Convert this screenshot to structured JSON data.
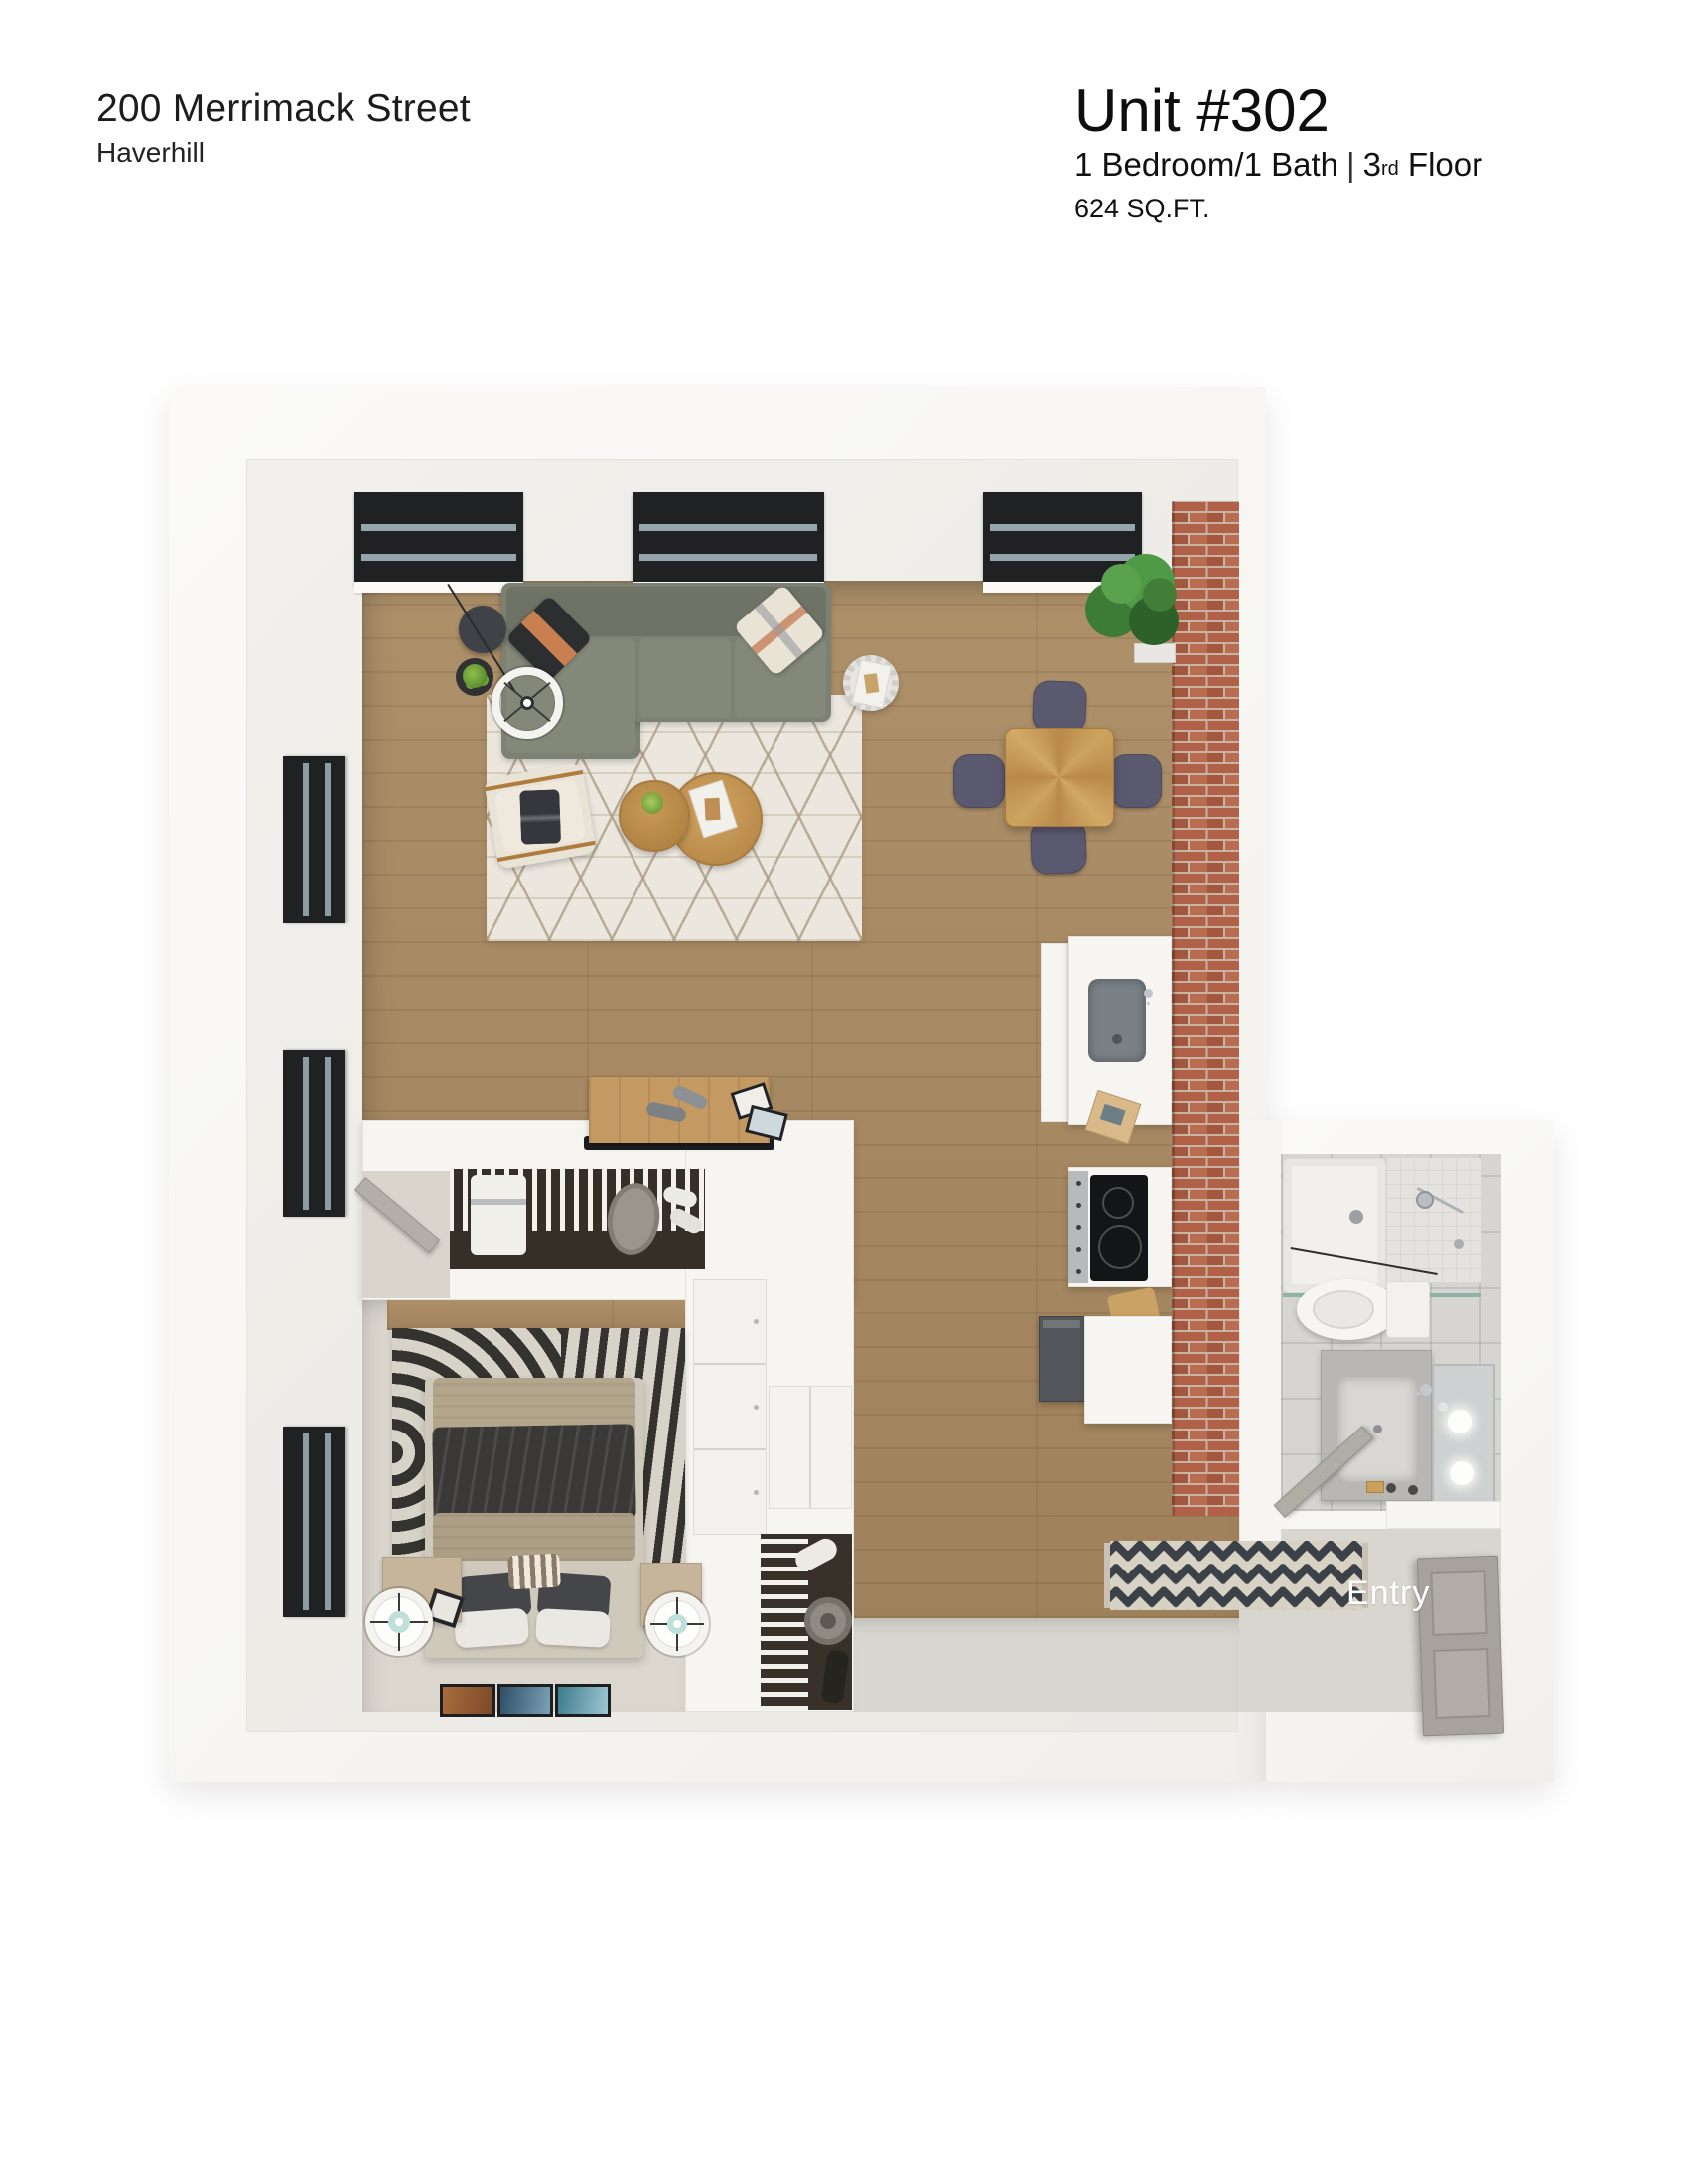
{
  "header": {
    "address": "200 Merrimack Street",
    "city": "Haverhill"
  },
  "unit": {
    "title": "Unit #302",
    "bed_bath": "1 Bedroom/1 Bath",
    "separator": "|",
    "floor_number": "3",
    "floor_ordinal": "rd",
    "floor_word": "Floor",
    "area": "624 SQ.FT."
  },
  "plan": {
    "entry_label": "Entry"
  },
  "colors": {
    "wall_white": "#f8f7f4",
    "wood_floor": "#a98a61",
    "brick": "#b06147",
    "sofa_olive": "#7d8173",
    "dining_chair_slate": "#5b5970",
    "bedroom_floor": "#dbd7cf",
    "living_rug": "#ebe7df",
    "accent_copper": "#c97f50",
    "lamp_teal": "#bfe0da",
    "window_frame": "#202122"
  }
}
